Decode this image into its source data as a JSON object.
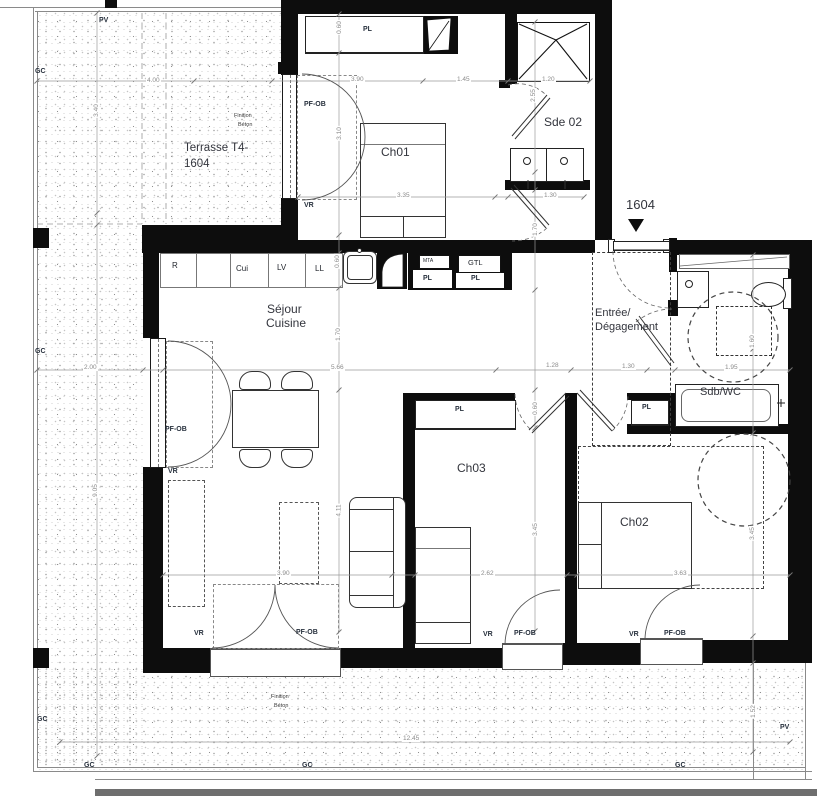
{
  "lot": {
    "number": "1604"
  },
  "rooms": {
    "terrasse_line1": "Terrasse T4-",
    "terrasse_line2": "1604",
    "ch01": "Ch01",
    "ch02": "Ch02",
    "ch03": "Ch03",
    "sde02": "Sde 02",
    "sdbwc": "Sdb/WC",
    "sejour": "Séjour",
    "cuisine": "Cuisine",
    "entree_line1": "Entrée/",
    "entree_line2": "Dégagement",
    "finition_line1": "Finition",
    "finition_line2": "Béton"
  },
  "tags": {
    "pl": "PL",
    "vr": "VR",
    "pf_ob": "PF-OB",
    "gc": "GC",
    "pv": "PV"
  },
  "kitchen": {
    "r": "R",
    "cui": "Cui",
    "lv": "LV",
    "ll": "LL",
    "mta": "MTA",
    "gtl": "GTL"
  },
  "dims": {
    "a400": "4.00",
    "a340": "3.40",
    "a200": "2.00",
    "a905": "9.05",
    "a060": "0.60",
    "a310": "3.10",
    "a390": "3.90",
    "a145": "1.45",
    "a120": "1.20",
    "a255": "2.55",
    "a335": "3.35",
    "a130": "1.30",
    "a170": "1.70",
    "a566": "5.66",
    "a128": "1.28",
    "a195": "1.95",
    "a160": "1.60",
    "a411": "4.11",
    "a262": "2.62",
    "a363": "3.63",
    "a345": "3.45",
    "a1245": "12.45",
    "a152": "1.52"
  },
  "colors": {
    "wall": "#0d0d0d",
    "label": "#27303d",
    "room_label": "#33353d",
    "dim": "#8b8b8b"
  }
}
